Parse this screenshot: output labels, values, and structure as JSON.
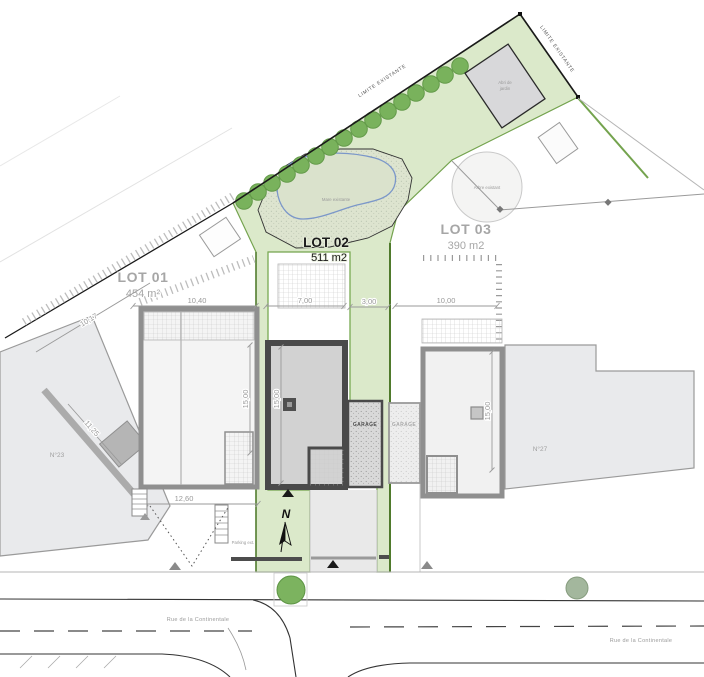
{
  "plan": {
    "lots": [
      {
        "name": "LOT 01",
        "area": "454 m²"
      },
      {
        "name": "LOT 02",
        "area": "511 m2"
      },
      {
        "name": "LOT 03",
        "area": "390 m2"
      }
    ],
    "existing_buildings": {
      "left": "N°23",
      "right": "N°27"
    },
    "garage_label": "GARAGE",
    "street_name": "Rue de la Continentale",
    "north_label": "N",
    "annotations": {
      "limite": "LIMITE EXISTANTE",
      "pond": "Mare existante",
      "shed_line1": "Abri de",
      "shed_line2": "jardin",
      "tree": "Arbre existant",
      "parking": "Parking ext."
    },
    "dimensions": {
      "front_lot01": "10,40",
      "front_lot02": "7,00",
      "front_gap": "3,00",
      "front_lot03": "10,00",
      "depth": "15,00",
      "rear_lot01": "12,60",
      "side_lot01": "10,17",
      "side_n23": "11,25"
    },
    "colors": {
      "garden": "#dbe9ca",
      "garden_edge": "#74a34e",
      "garden_edge_dark": "#4f7a2c",
      "tree": "#79b25c",
      "pond_outline": "#7b97c9",
      "new_wall": "#4a4a4a",
      "existing_fill": "#e9eaec",
      "dimension_text": "#9a9a9a"
    }
  }
}
